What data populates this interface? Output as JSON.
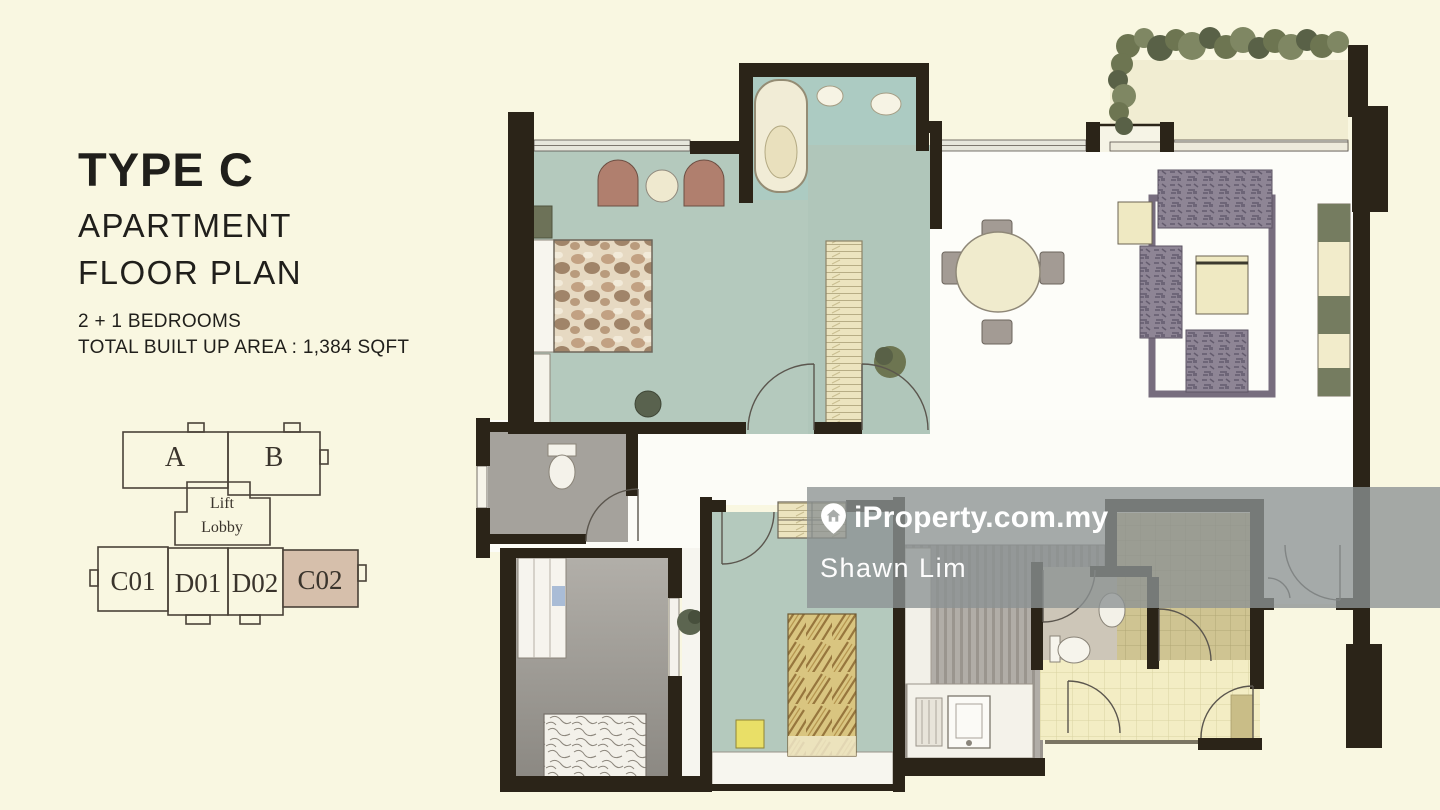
{
  "panel": {
    "title": "TYPE C",
    "subtitle_1": "APARTMENT",
    "subtitle_2": "FLOOR PLAN",
    "detail_1": "2 + 1 BEDROOMS",
    "detail_2": "TOTAL BUILT UP AREA : 1,384 SQFT"
  },
  "key_plan": {
    "unit_a": "A",
    "unit_b": "B",
    "lobby_line1": "Lift",
    "lobby_line2": "Lobby",
    "unit_c01": "C01",
    "unit_d01": "D01",
    "unit_d02": "D02",
    "unit_c02": "C02",
    "highlighted_unit": "C02",
    "highlight_color": "#d6bfab"
  },
  "watermark": {
    "brand": "iProperty.com.my",
    "agent": "Shawn Lim",
    "band_color": "rgba(140,146,148,0.78)",
    "text_color": "#ffffff"
  },
  "colors": {
    "background": "#f9f7e1",
    "wall": "#2b2418",
    "floor_teal": "#b4c9bd",
    "floor_gray": "#a9a6a1",
    "floor_white": "#fdfdf9",
    "floor_yellow_tile": "#f3edc4",
    "floor_khaki_tile": "#cfc492",
    "balcony": "#f1edd2",
    "planter_green": "#6d7551"
  }
}
